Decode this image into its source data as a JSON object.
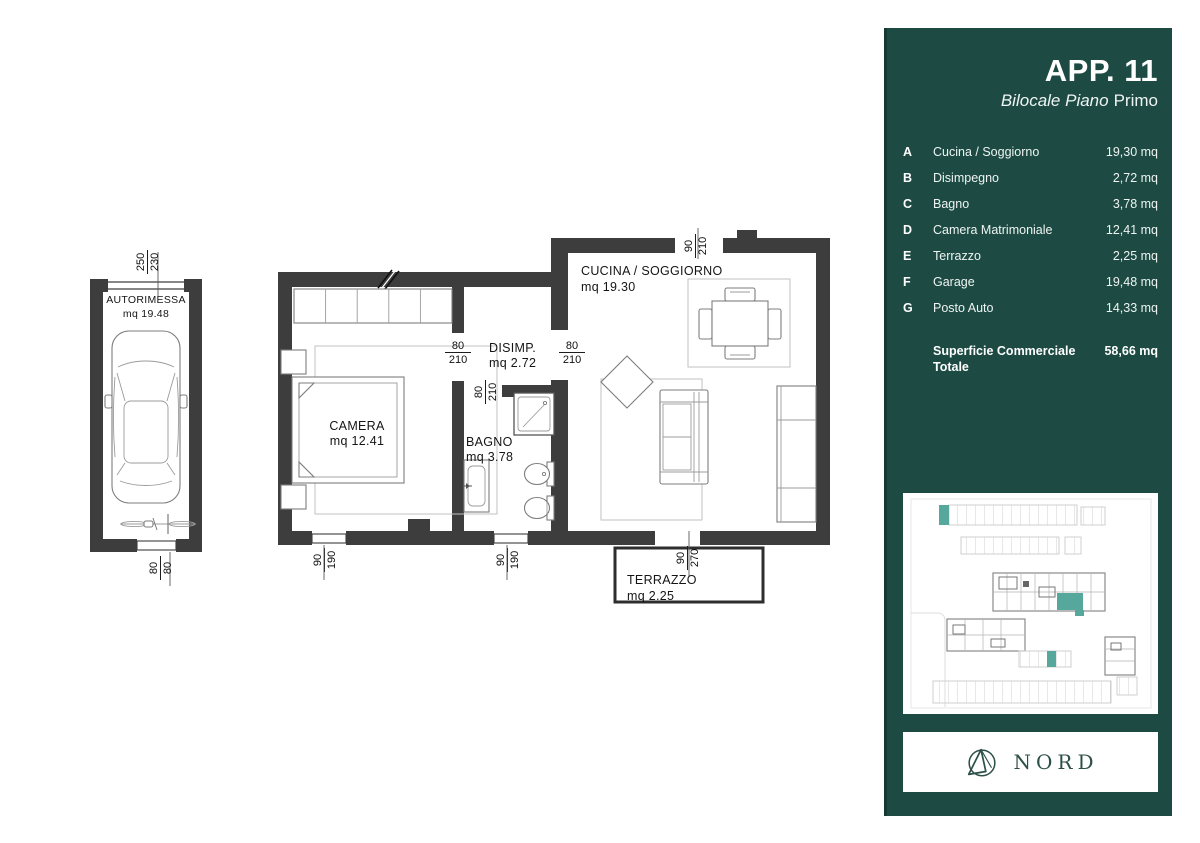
{
  "panel": {
    "title": "APP. 11",
    "subtitle_italic": "Bilocale Piano",
    "subtitle_regular": "Primo",
    "rooms": [
      {
        "letter": "A",
        "name": "Cucina / Soggiorno",
        "area": "19,30 mq"
      },
      {
        "letter": "B",
        "name": "Disimpegno",
        "area": "2,72 mq"
      },
      {
        "letter": "C",
        "name": "Bagno",
        "area": "3,78 mq"
      },
      {
        "letter": "D",
        "name": "Camera Matrimoniale",
        "area": "12,41 mq"
      },
      {
        "letter": "E",
        "name": "Terrazzo",
        "area": "2,25 mq"
      },
      {
        "letter": "F",
        "name": "Garage",
        "area": "19,48 mq"
      },
      {
        "letter": "G",
        "name": "Posto Auto",
        "area": "14,33 mq"
      }
    ],
    "total_label": "Superficie Commerciale Totale",
    "total_value": "58,66 mq",
    "north_label": "NORD",
    "colors": {
      "panel_bg": "#1d4b44",
      "accent_teal": "#55a89b",
      "wall": "#3d3d3d"
    }
  },
  "floorplan": {
    "rooms": {
      "garage": {
        "name": "AUTORIMESSA",
        "area": "mq 19.48"
      },
      "camera": {
        "name": "CAMERA",
        "area": "mq 12.41"
      },
      "disimpegno": {
        "name": "DISIMP.",
        "area": "mq 2.72"
      },
      "bagno": {
        "name": "BAGNO",
        "area": "mq 3.78"
      },
      "cucina": {
        "name": "CUCINA / SOGGIORNO",
        "area": "mq 19.30"
      },
      "terrazzo": {
        "name": "TERRAZZO",
        "area": "mq 2.25"
      }
    },
    "dimensions": {
      "garage_door": {
        "a": "250",
        "b": "230"
      },
      "garage_rear_door": {
        "a": "80",
        "b": "80"
      },
      "camera_door": {
        "a": "80",
        "b": "210"
      },
      "entry_door": {
        "a": "80",
        "b": "210"
      },
      "bagno_door": {
        "a": "80",
        "b": "210"
      },
      "cucina_window": {
        "a": "90",
        "b": "210"
      },
      "camera_window": {
        "a": "90",
        "b": "190"
      },
      "bagno_window": {
        "a": "90",
        "b": "190"
      },
      "terrazzo_door": {
        "a": "90",
        "b": "270"
      }
    }
  }
}
